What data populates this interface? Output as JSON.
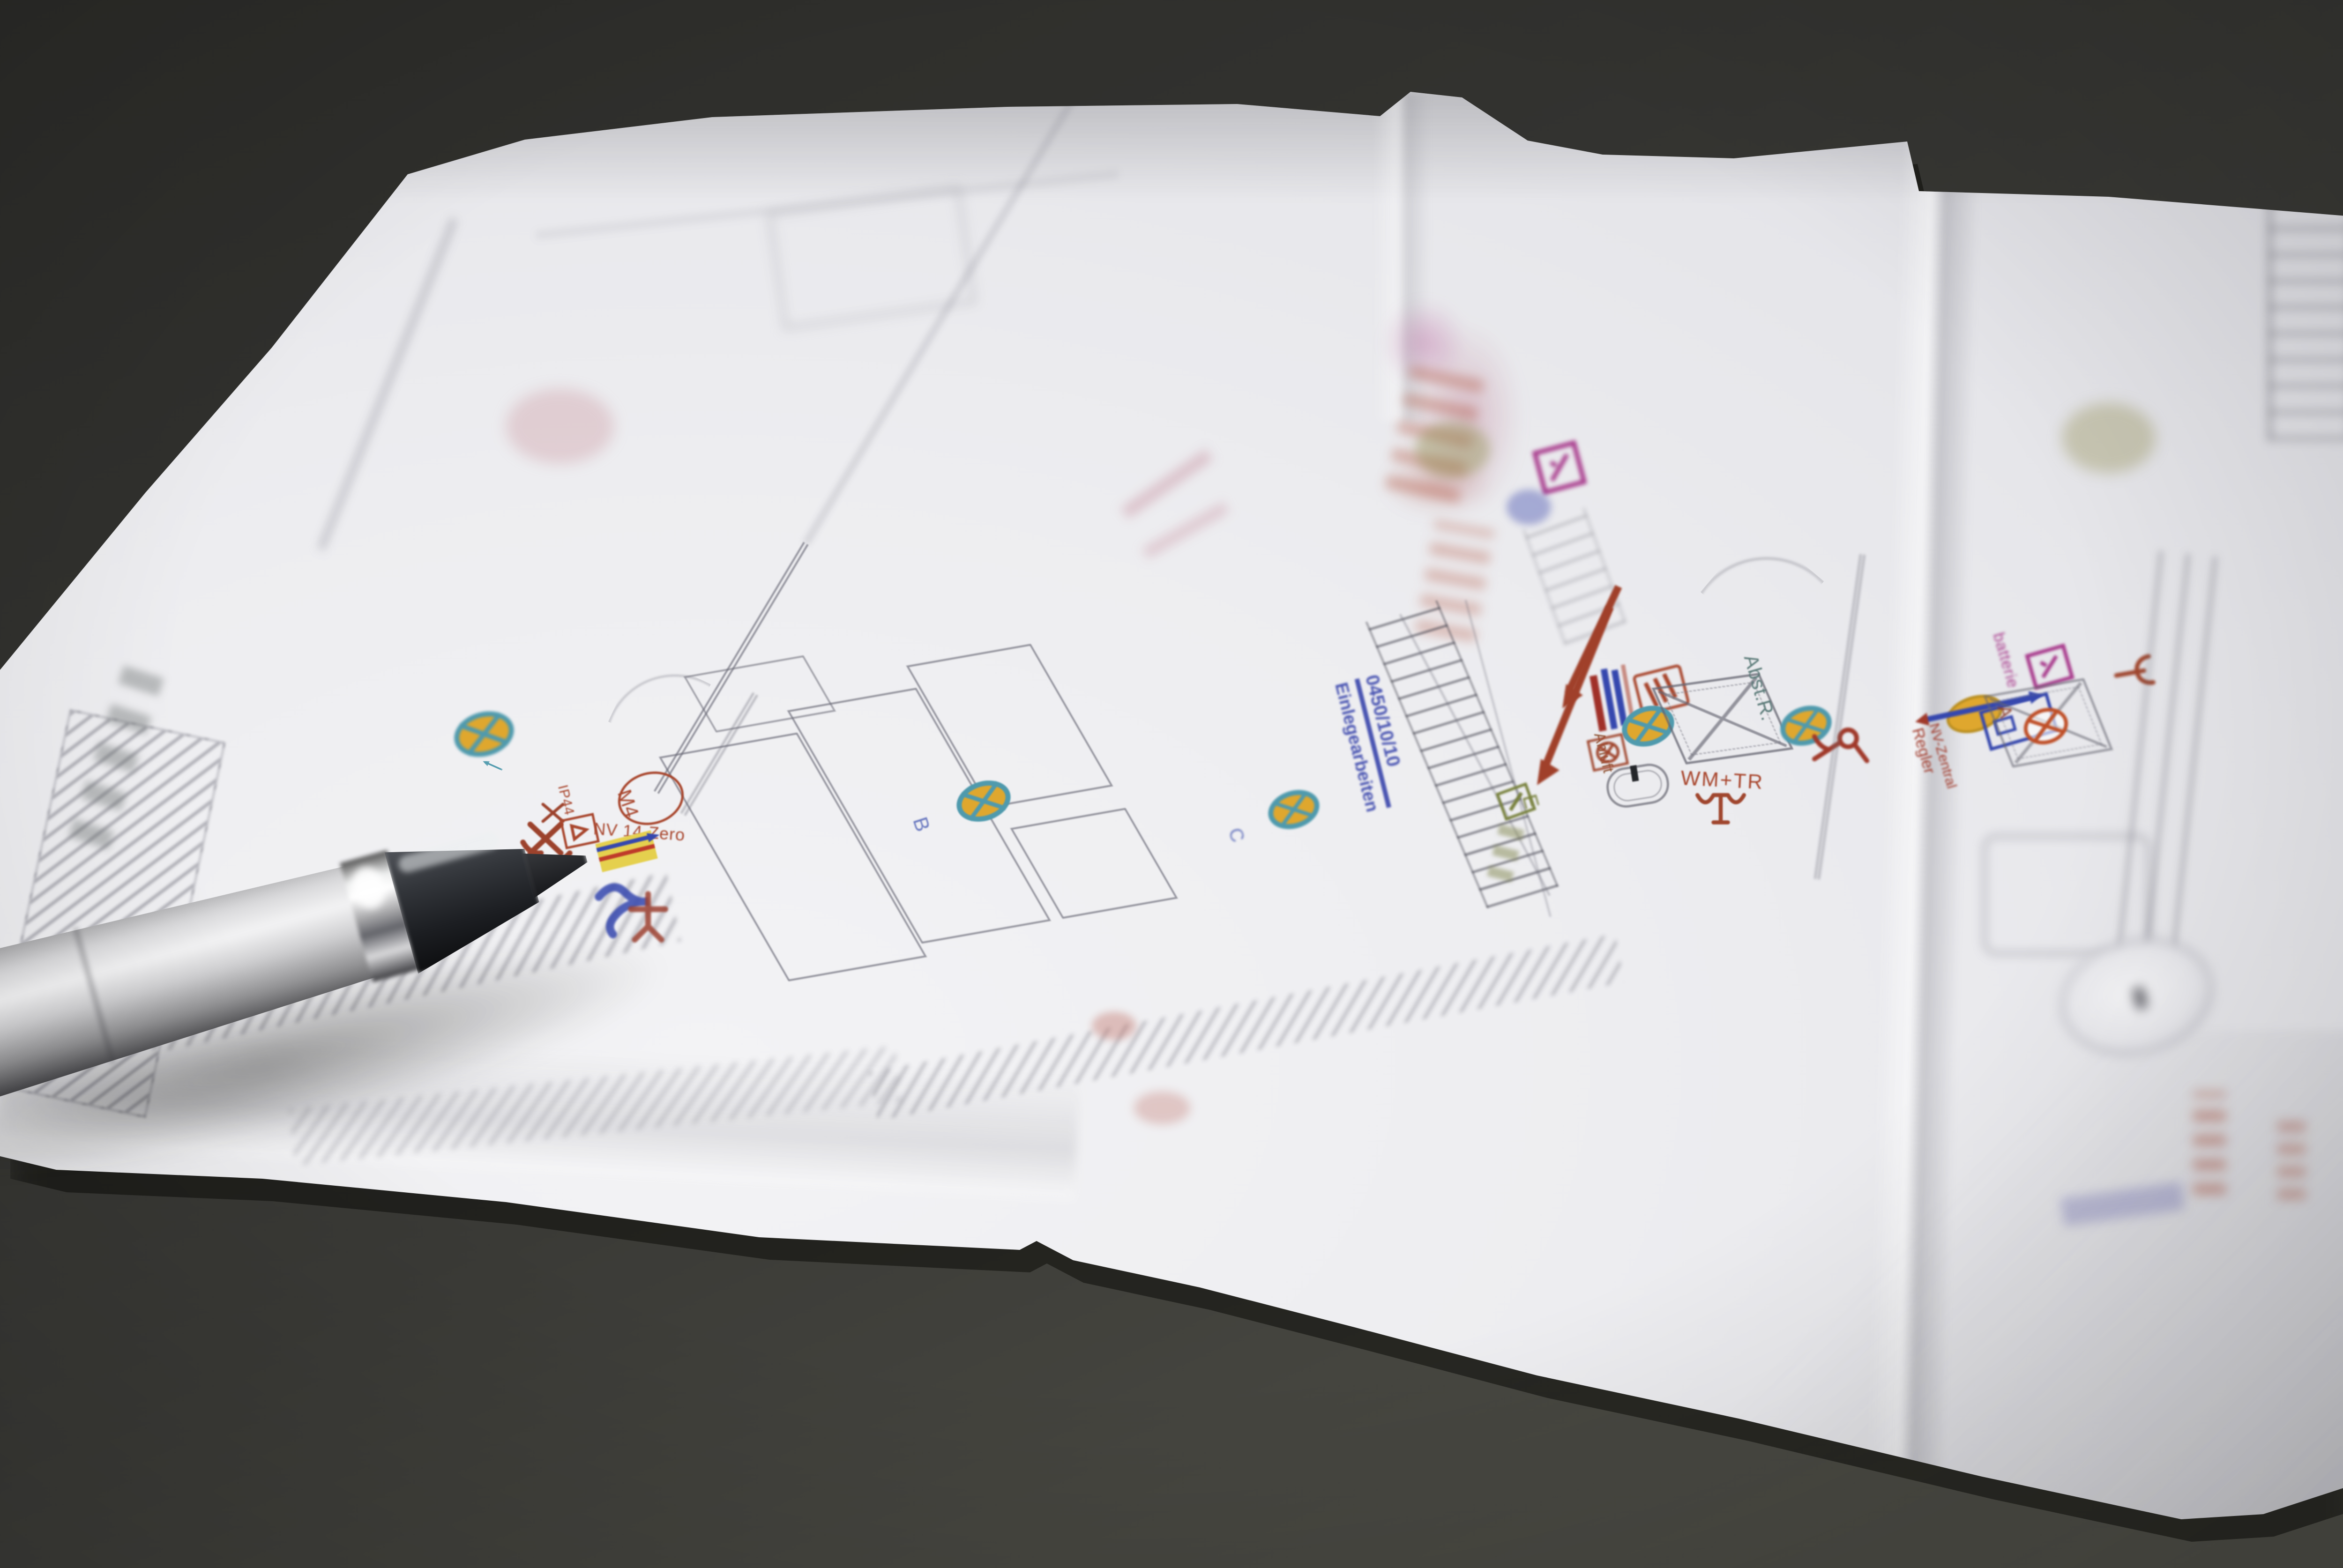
{
  "palette": {
    "table_top": "#2b2b28",
    "table_bottom": "#4c4c45",
    "paper": "#e6e6ea",
    "paper_bright": "#f3f3f5",
    "pen_silver": "#cacacc",
    "pen_grip": "#3a3c40",
    "annotation_red": "#a8452c",
    "stamp_blue": "#4a55b2",
    "magenta": "#a83a8c",
    "teal_ring": "#4f9aad",
    "lamp_yellow": "#dfa72e",
    "highlight_yellow": "#e5d04e",
    "wire_blue": "#3547ae",
    "wire_red": "#bf3a2a",
    "olive_green": "#78813d",
    "line_grey": "#8e8e99",
    "label_teal": "#5a7a78"
  },
  "plan": {
    "texts": {
      "ip44": "IP44",
      "m4": "M4",
      "nv_zero": "NV 14-Zero",
      "wm_tr": "WM+TR",
      "abluft": "Abluft",
      "abst_r": "Abst.R.",
      "stamp_line1": "0450/10/10",
      "stamp_line2": "Einlegearbeiten",
      "regler_line1": "NV-Zentral",
      "regler_line2": "Regler",
      "batterie_fragment": "batterie",
      "light_a": "A",
      "light_b": "B",
      "light_c": "C",
      "stair_e": "E"
    }
  }
}
